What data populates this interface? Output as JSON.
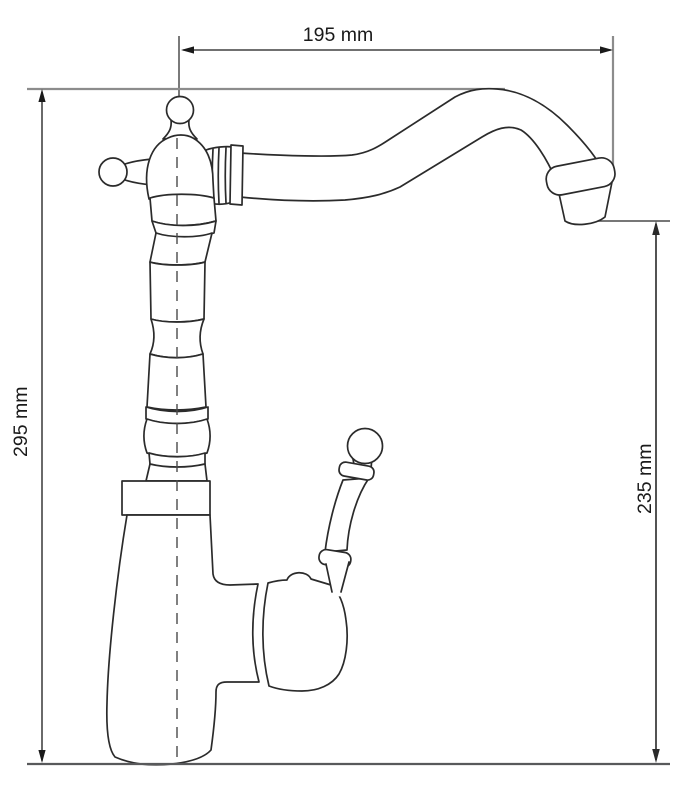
{
  "drawing": {
    "unit": "mm",
    "dimensions": {
      "top_width": {
        "label": "195 mm",
        "value": 195,
        "orientation": "horizontal",
        "position": "top"
      },
      "overall_height": {
        "label": "295 mm",
        "value": 295,
        "orientation": "vertical",
        "position": "left"
      },
      "spout_height": {
        "label": "235 mm",
        "value": 235,
        "orientation": "vertical",
        "position": "right"
      }
    },
    "colors": {
      "background": "#ffffff",
      "outline": "#2b2b2b",
      "dimension_line": "#1a1a1a",
      "extension_line": "#8c8c8c",
      "ground_line": "#58595b",
      "label_text": "#1a1a1a"
    }
  }
}
